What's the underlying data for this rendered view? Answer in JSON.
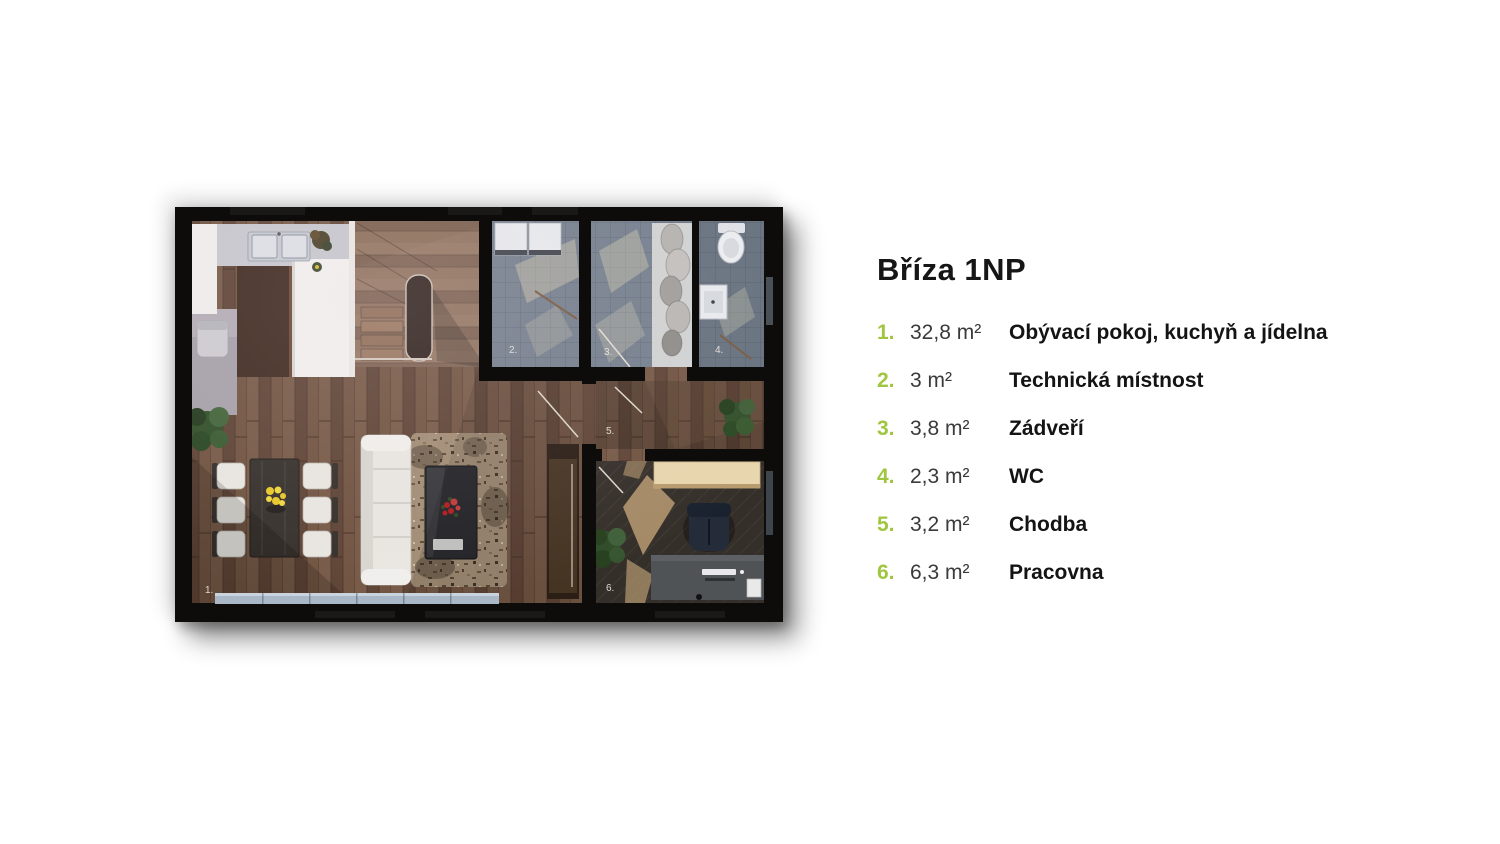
{
  "title": "Bříza 1NP",
  "accent_color": "#9fc63e",
  "legend": {
    "items": [
      {
        "num": "1.",
        "area": "32,8 m²",
        "name": "Obývací pokoj, kuchyň a jídelna"
      },
      {
        "num": "2.",
        "area": "3 m²",
        "name": "Technická místnost"
      },
      {
        "num": "3.",
        "area": "3,8 m²",
        "name": "Zádveří"
      },
      {
        "num": "4.",
        "area": "2,3 m²",
        "name": "WC"
      },
      {
        "num": "5.",
        "area": "3,2 m²",
        "name": "Chodba"
      },
      {
        "num": "6.",
        "area": "6,3 m²",
        "name": "Pracovna"
      }
    ]
  },
  "plan": {
    "room_labels": [
      "1.",
      "2.",
      "3.",
      "4.",
      "5.",
      "6."
    ],
    "colors": {
      "wall": "#0e0c0b",
      "wood_floor": "#6b4e3e",
      "stair_wood": "#826450",
      "tile_floor": "#75808e",
      "office_floor": "#352f2a",
      "window_glass": "#a9b7c7",
      "counter_white": "#f2f1ef"
    }
  }
}
